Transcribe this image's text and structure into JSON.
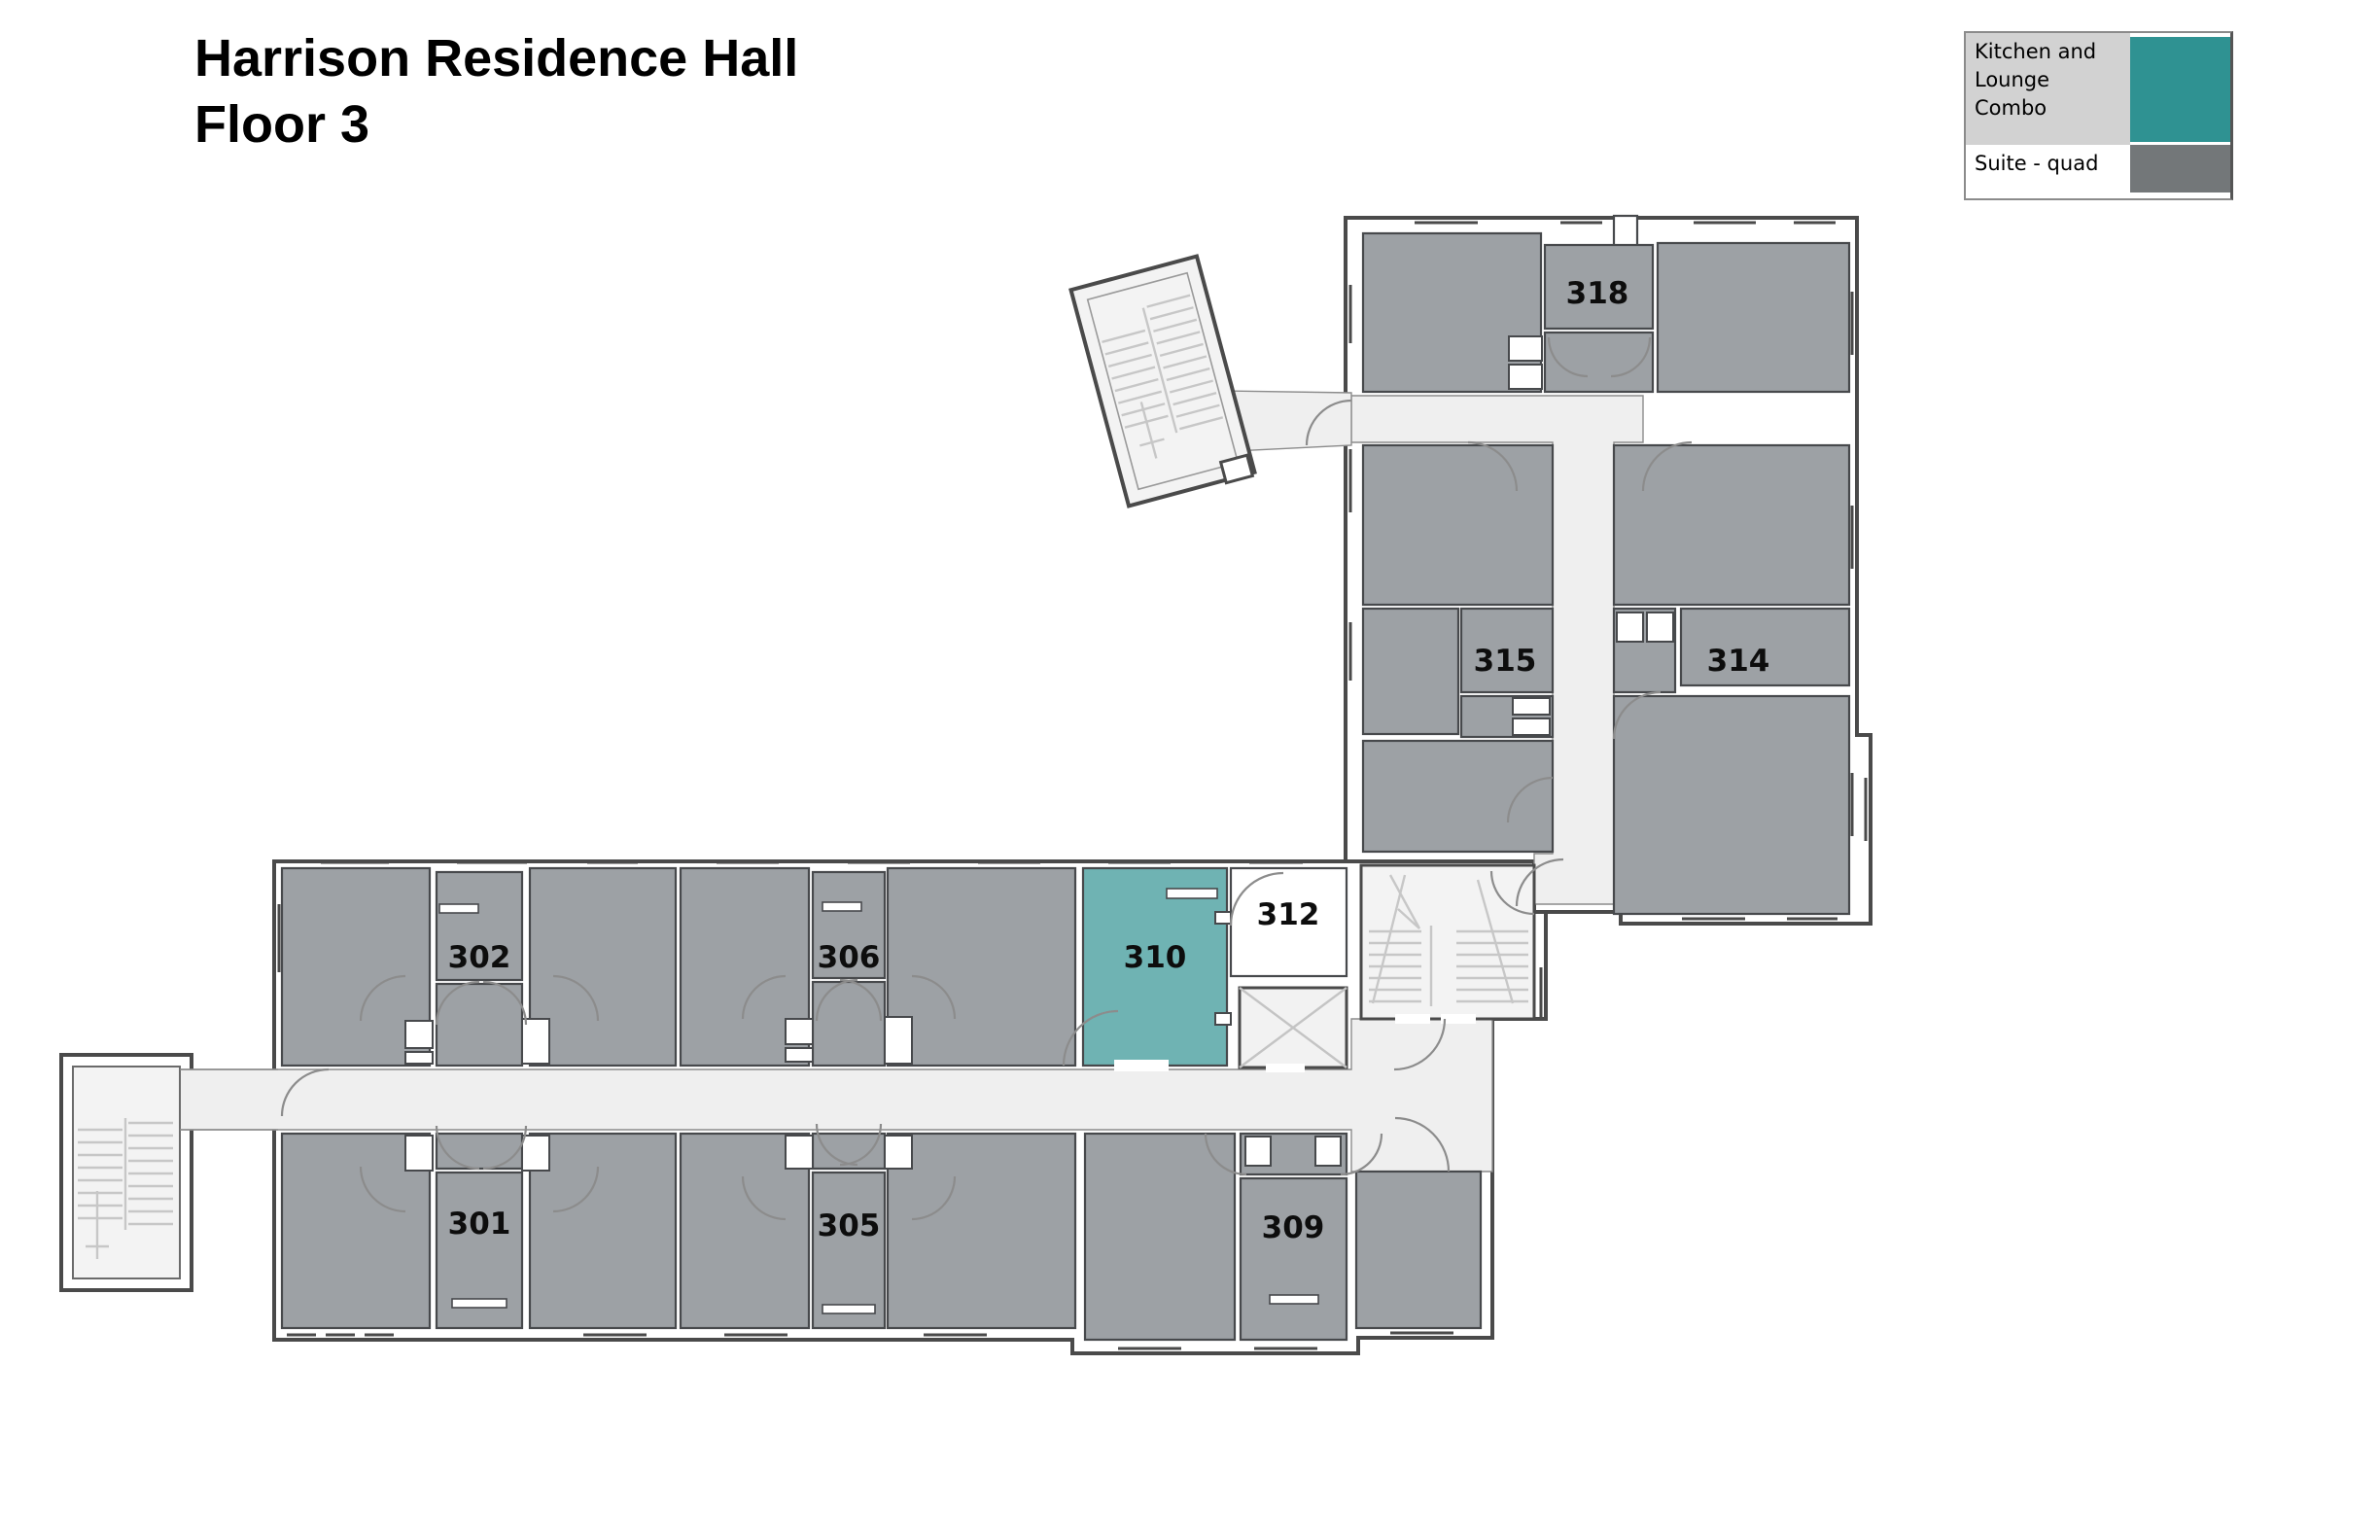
{
  "title": {
    "line1": "Harrison Residence Hall",
    "line2": "Floor 3"
  },
  "legend": {
    "items": [
      {
        "label": "Kitchen and\nLounge\nCombo",
        "swatch": "#2f9292",
        "row_bg": "#d2d2d2"
      },
      {
        "label": "Suite - quad",
        "swatch": "#737779",
        "row_bg": "#ffffff"
      }
    ]
  },
  "rooms": {
    "r301": "301",
    "r302": "302",
    "r305": "305",
    "r306": "306",
    "r309": "309",
    "r310": "310",
    "r312": "312",
    "r314": "314",
    "r315": "315",
    "r318": "318"
  },
  "colors": {
    "kitchen_lounge_room": "#6fb3b3",
    "suite_quad_room": "#9da1a5",
    "legend_kitchen": "#2f9292",
    "legend_suite": "#737779",
    "corridor": "#efefef",
    "wall": "#4a4a4a"
  }
}
